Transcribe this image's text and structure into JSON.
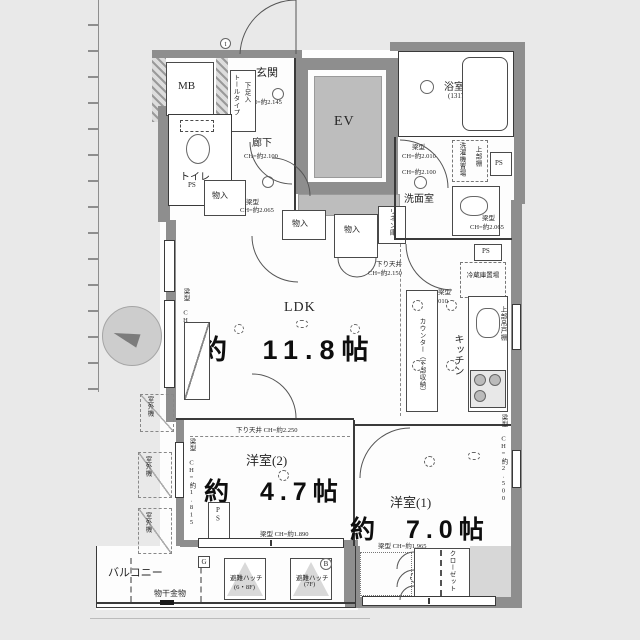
{
  "common": {
    "mb": "MB",
    "ev": "EV",
    "ps": "PS",
    "marker_t": "t",
    "marker_g": "G",
    "marker_b": "B"
  },
  "entry": {
    "genkan": "玄関",
    "genkan_ch": "CH=約2.145",
    "shoes": "下足入",
    "shoes_type": "トールタイプ",
    "hall": "廊下",
    "hall_ch": "CH=約2.100"
  },
  "toilet": {
    "label": "トイレ"
  },
  "bath": {
    "label": "浴室",
    "size": "(1317)"
  },
  "wash": {
    "label": "洗面室",
    "beam_top": "梁型",
    "beam_top_ch": "CH=約2.010",
    "ch": "CH=約2.100",
    "washer": "洗濯機置場",
    "shelf": "上部棚",
    "beam_bottom": "梁型",
    "beam_bottom_ch": "CH=約2.065",
    "linen": "リネン庫"
  },
  "storage": {
    "monoire": "物入",
    "beam": "梁型",
    "beam_ch": "CH=約2.065"
  },
  "kitchen": {
    "label": "キッチン",
    "counter": "カウンター（下部収納）",
    "fridge": "冷蔵庫置場",
    "upper": "上部吊戸棚",
    "down_ceiling": "下り天井",
    "down_ceiling_ch": "CH=約2.150",
    "beam": "梁型",
    "beam_ch": "CH=約2.010"
  },
  "ldk": {
    "label": "LDK",
    "size": "約 11.8帖",
    "beam_v": "梁型 CH=約1.815"
  },
  "west2": {
    "label": "洋室(2)",
    "size": "約 4.7帖",
    "down_ceiling": "下り天井 CH=約2.250",
    "beam_bottom": "梁型 CH=約1.890",
    "beam_v": "梁型 CH=約1.815"
  },
  "west1": {
    "label": "洋室(1)",
    "size": "約 7.0帖",
    "beam": "梁型 CH=約1.965",
    "beam_v": "梁型 CH=約2.500",
    "closet": "クローゼット"
  },
  "balcony": {
    "label": "バルコニー",
    "drying": "物干金物",
    "hatch": "避難ハッチ",
    "hatch1_floor": "(6・8F)",
    "hatch2_floor": "(7F)",
    "outdoor": "室外機"
  }
}
